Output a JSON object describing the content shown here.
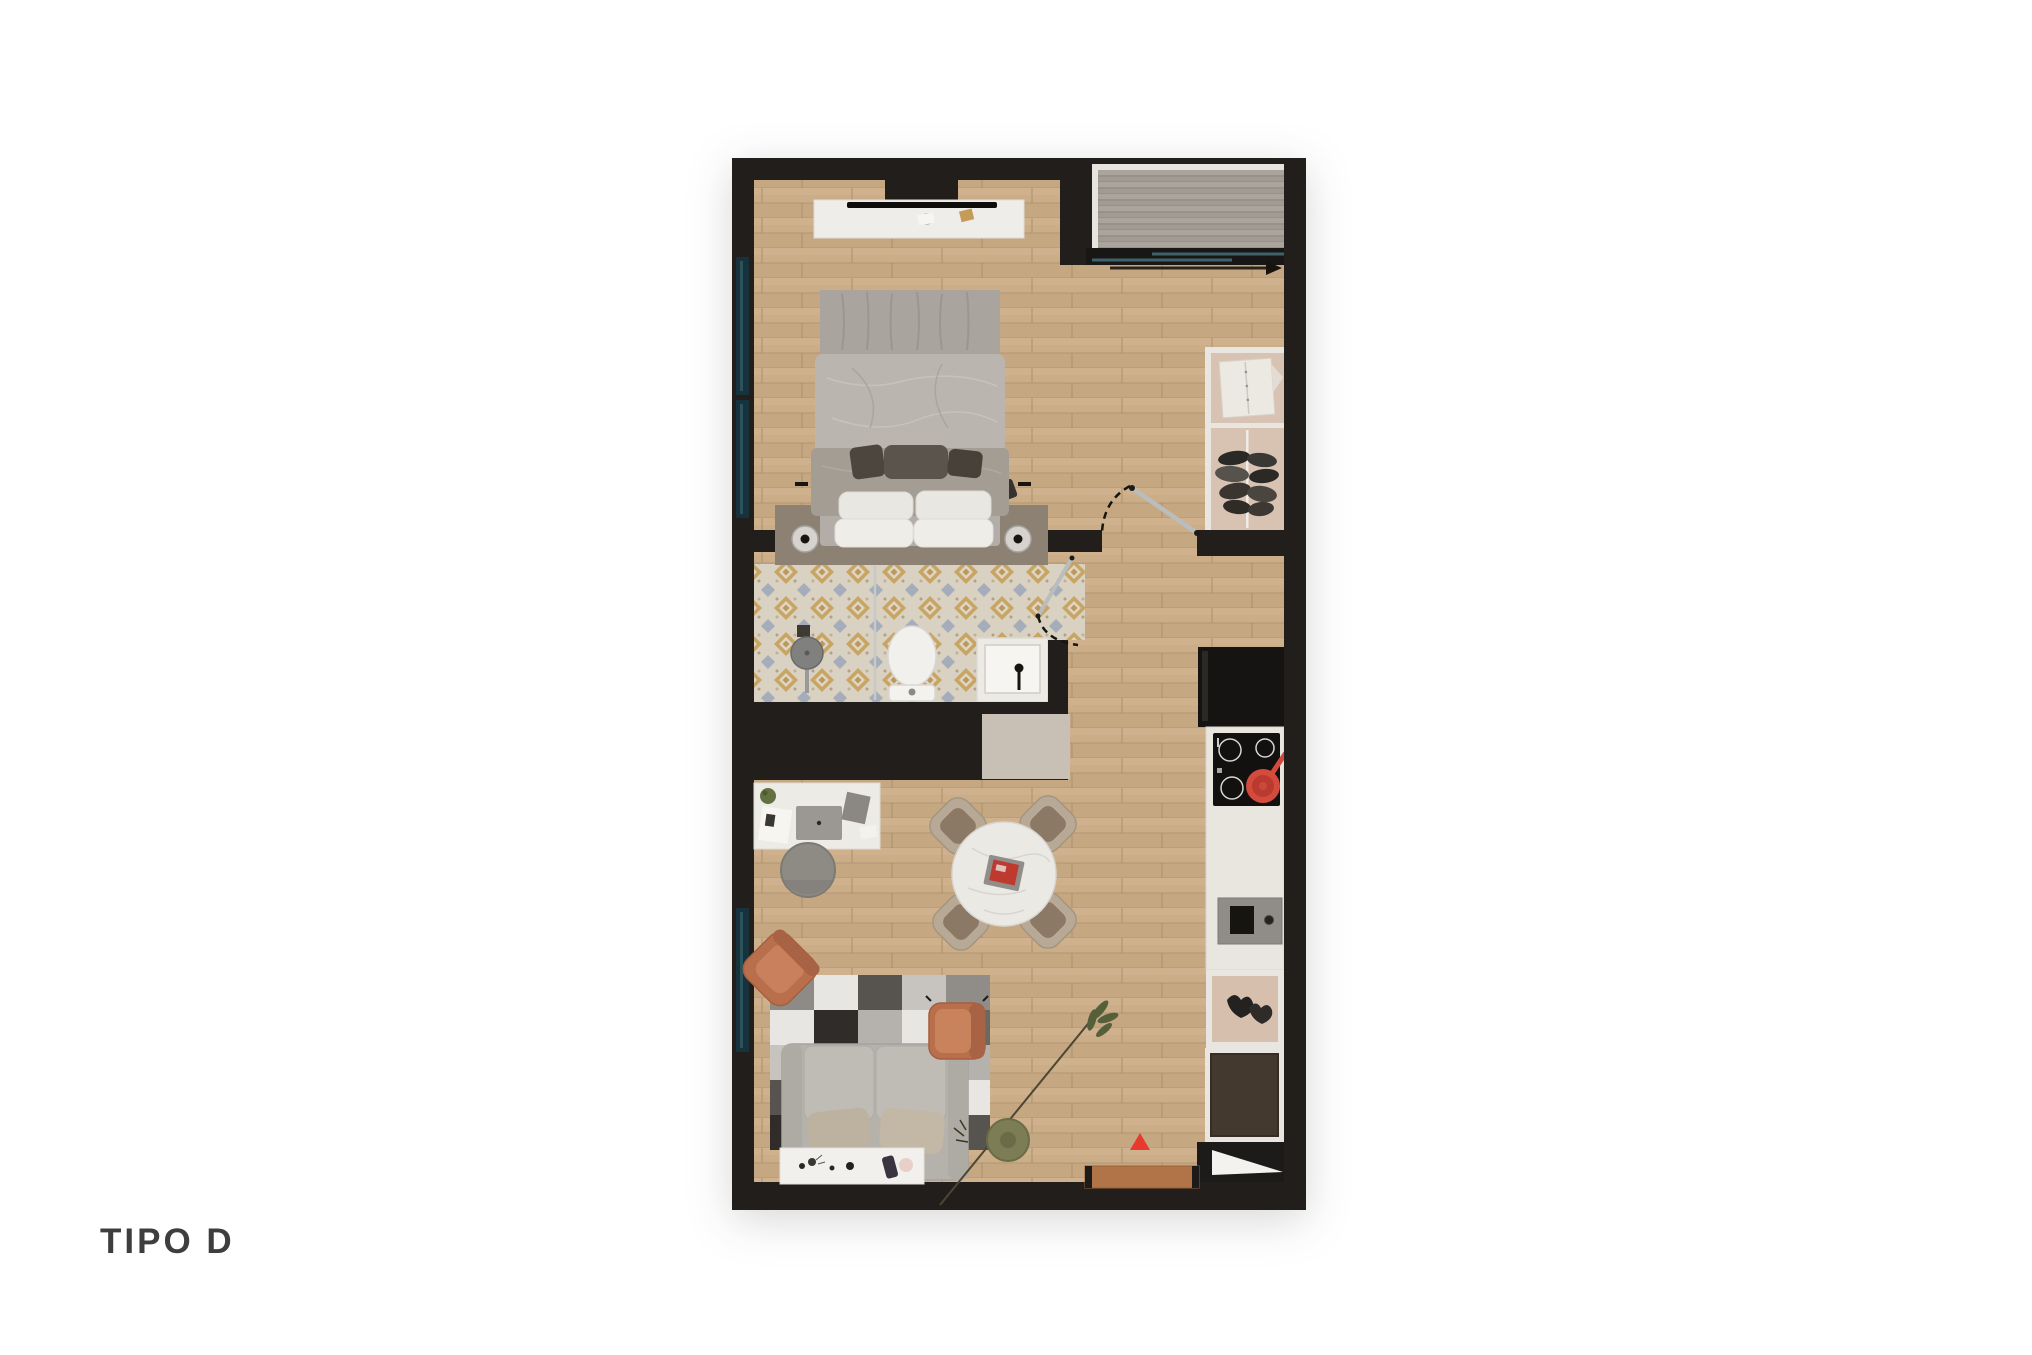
{
  "page": {
    "background": "#ffffff",
    "title": "TIPO D"
  },
  "plan": {
    "title": "TIPO D",
    "view": "top-down rendered floor plan",
    "colors": {
      "wall": "#211e1b",
      "wood_floor": "#cbae88",
      "balcony_deck": "#a19b93",
      "bathroom_tile_base": "#d9d1c1",
      "bathroom_tile_mustard": "#c79e52",
      "bathroom_tile_blue": "#9aa4b8",
      "bed_linen": "#b8b3ad",
      "headboard": "#8c8173",
      "armchair_terracotta": "#b96f4c",
      "sofa_gray": "#b5b1ab",
      "kitchen_counter": "#e9e6e0",
      "fridge": "#161412",
      "pan_red": "#d44a3c",
      "entrance_marker_red": "#e8392f",
      "doormat_brown": "#b17448",
      "wardrobe_interior": "#d8c2b2",
      "window_glass": "#274e57"
    },
    "rooms": [
      {
        "name": "bedroom",
        "contents": [
          "tv-console",
          "tv",
          "double-bed",
          "pillows",
          "cushions",
          "headboard-platform",
          "nightstand-left",
          "nightstand-right",
          "table-lamp-left",
          "table-lamp-right",
          "wall-sconces",
          "window"
        ]
      },
      {
        "name": "balcony",
        "contents": [
          "deck-floor",
          "sliding-glass-door",
          "direction-arrow"
        ]
      },
      {
        "name": "bathroom",
        "contents": [
          "patterned-tile-floor",
          "shower",
          "shower-glass-partition",
          "toilet",
          "washbasin",
          "black-faucet",
          "swing-door"
        ]
      },
      {
        "name": "hall-dressing",
        "contents": [
          "wardrobe",
          "folded-shirt",
          "hanging-clothes",
          "bedroom-swing-door"
        ]
      },
      {
        "name": "kitchen",
        "contents": [
          "refrigerator",
          "cooktop-4-burners",
          "red-frying-pan",
          "counter",
          "sink-unit",
          "open-shelf-decor",
          "base-cabinet",
          "service-shaft"
        ]
      },
      {
        "name": "living-dining",
        "contents": [
          "desk",
          "laptop",
          "papers",
          "desk-plant",
          "stool",
          "round-dining-table",
          "red-tray",
          "dining-chair-x4",
          "patchwork-rug",
          "sofa",
          "sofa-pillows",
          "console-table",
          "perfume-decor",
          "armchair-left",
          "armchair-right",
          "floor-plant",
          "storage-cabinet-beige",
          "entrance-triangle",
          "doormat"
        ]
      }
    ],
    "markers": {
      "entrance_triangle": "red triangle pointing up at entrance",
      "flow_arrow": "dark arrow pointing right below balcony door",
      "door_swings": "dashed quarter-circle arcs"
    }
  }
}
